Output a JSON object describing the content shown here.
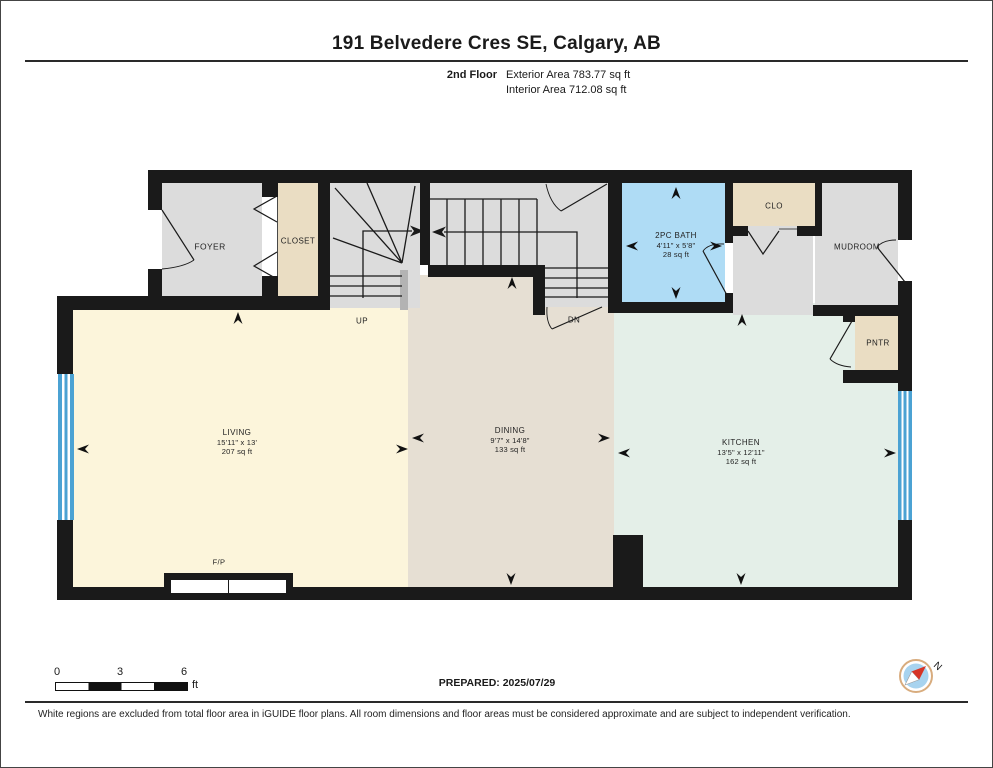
{
  "header": {
    "title": "191 Belvedere Cres SE, Calgary, AB",
    "floor_label": "2nd Floor",
    "exterior_area": "Exterior Area 783.77 sq ft",
    "interior_area": "Interior Area 712.08 sq ft"
  },
  "rooms": {
    "foyer": {
      "name": "FOYER"
    },
    "closet": {
      "name": "CLOSET"
    },
    "bath": {
      "name": "2PC BATH",
      "dims": "4'11\" x 5'8\"",
      "area": "28 sq ft"
    },
    "clo": {
      "name": "CLO"
    },
    "mudroom": {
      "name": "MUDROOM"
    },
    "pantry": {
      "name": "PNTR"
    },
    "living": {
      "name": "LIVING",
      "dims": "15'11\" x 13'",
      "area": "207 sq ft"
    },
    "dining": {
      "name": "DINING",
      "dims": "9'7\" x 14'8\"",
      "area": "133 sq ft"
    },
    "kitchen": {
      "name": "KITCHEN",
      "dims": "13'5\" x 12'11\"",
      "area": "162 sq ft"
    }
  },
  "stairs": {
    "up": "UP",
    "down": "DN"
  },
  "fireplace": {
    "label": "F/P"
  },
  "scale_bar": {
    "ticks": [
      "0",
      "3",
      "6"
    ],
    "unit": "ft"
  },
  "compass": {
    "north_label": "N"
  },
  "footer": {
    "prepared": "PREPARED: 2025/07/29",
    "disclaimer": "White regions are excluded from total floor area in iGUIDE floor plans. All room dimensions and floor areas must be considered approximate and are subject to independent verification."
  },
  "colors": {
    "wall": "#1a1a1a",
    "living": "#FCF5DB",
    "dining": "#E6DFD3",
    "kitchen": "#E4EFE8",
    "bath": "#AFDCF5",
    "closet_tan": "#EADDC3",
    "hall_gray": "#DCDCDC",
    "window_blue": "#4BA2D3"
  }
}
